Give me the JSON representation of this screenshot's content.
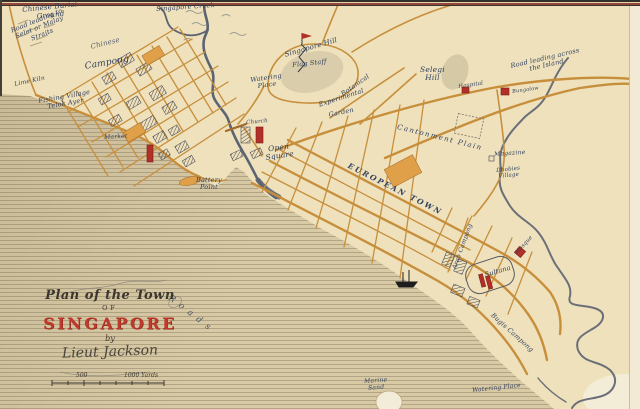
{
  "map": {
    "cartouche": {
      "title": "Plan of the Town",
      "of": "OF",
      "name": "SINGAPORE",
      "by": "by",
      "author": "Lieut Jackson",
      "scale_left": "500",
      "scale_right": "1000 Yards"
    },
    "labels": [
      {
        "name": "chinese-burial-ground",
        "text": "Chinese Burial\nGround"
      },
      {
        "name": "road-to-selat",
        "text": "Road leading to\nSelat or Malay\nStraits"
      },
      {
        "name": "singapore-creek",
        "text": "Singapore Creek"
      },
      {
        "name": "chinese-campong-word1",
        "text": "Chinese"
      },
      {
        "name": "chinese-campong-word2",
        "text": "Campong"
      },
      {
        "name": "lime-kiln",
        "text": "Lime Kiln"
      },
      {
        "name": "fishing-village",
        "text": "Fishing Village\nTelok Ayer"
      },
      {
        "name": "market",
        "text": "Market"
      },
      {
        "name": "battery-point",
        "text": "Battery\nPoint"
      },
      {
        "name": "singapore-hill",
        "text": "Singapore Hill"
      },
      {
        "name": "flag-staff",
        "text": "Flag Staff"
      },
      {
        "name": "watering-place-river",
        "text": "Watering\nPlace"
      },
      {
        "name": "botanical",
        "text": "Botanical"
      },
      {
        "name": "experimental",
        "text": "Experimental"
      },
      {
        "name": "garden",
        "text": "Garden"
      },
      {
        "name": "church",
        "text": "Church"
      },
      {
        "name": "open-square",
        "text": "Open\nSquare"
      },
      {
        "name": "european-town",
        "text": "EUROPEAN TOWN"
      },
      {
        "name": "selegi-hill",
        "text": "Selegi\nHill"
      },
      {
        "name": "hospital",
        "text": "Hospital"
      },
      {
        "name": "bungalow",
        "text": "Bungalow"
      },
      {
        "name": "road-across-island",
        "text": "Road leading across\nthe Island"
      },
      {
        "name": "cantonment-plain",
        "text": "Cantonment Plain"
      },
      {
        "name": "magazine",
        "text": "Magazine"
      },
      {
        "name": "dhobies-village",
        "text": "Dhobies\nVillage"
      },
      {
        "name": "arab-campong",
        "text": "Arab Campong"
      },
      {
        "name": "mosque",
        "text": "Mosque"
      },
      {
        "name": "sultana",
        "text": "Sultana"
      },
      {
        "name": "bugis-campong",
        "text": "Bugis Campong"
      },
      {
        "name": "watering-place-shore",
        "text": "Watering Place"
      },
      {
        "name": "marine-sand",
        "text": "Marine\nSand"
      },
      {
        "name": "roads-anchorage",
        "text": "Roads"
      }
    ],
    "colors": {
      "paper": "#eee1bc",
      "sea": "#d9caa6",
      "road": "#c78f3c",
      "ink": "#33425f",
      "red_building": "#b23028",
      "river": "#5c6472",
      "title_red": "#bf3a2b"
    }
  }
}
